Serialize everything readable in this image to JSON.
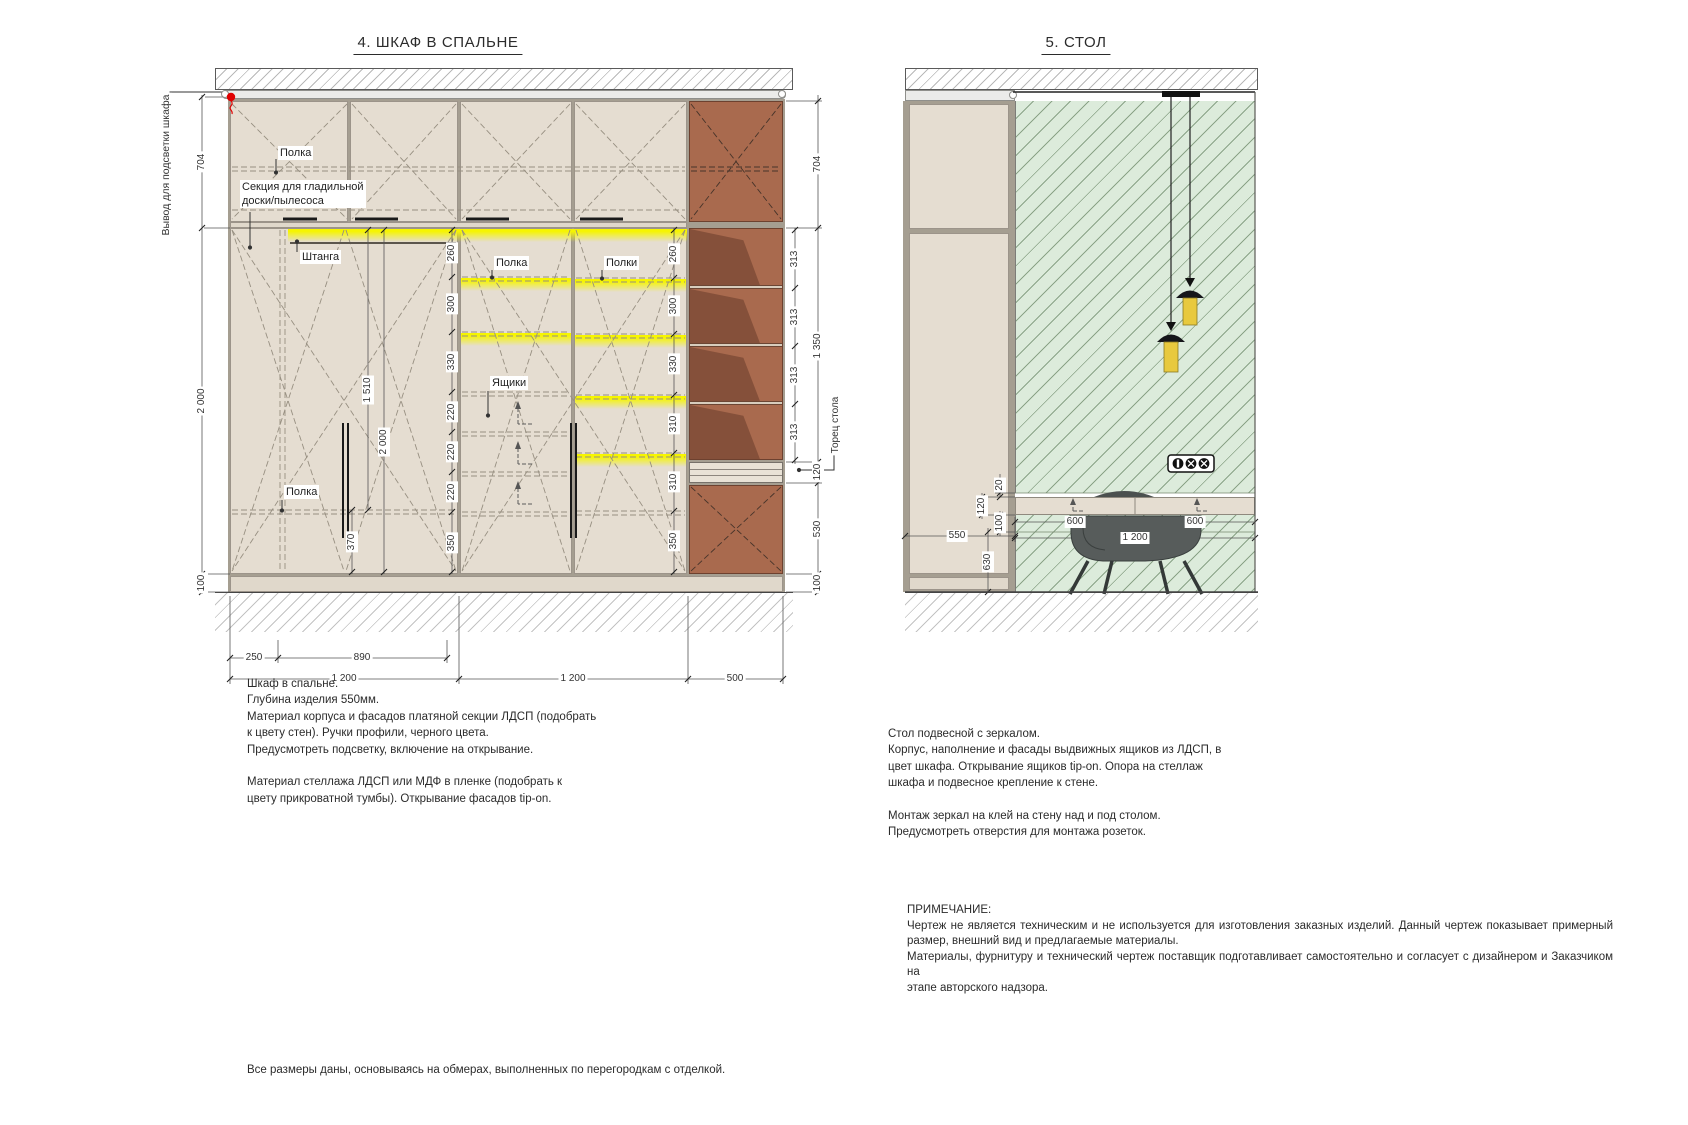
{
  "wardrobe": {
    "title": "4. ШКАФ В СПАЛЬНЕ",
    "callouts": {
      "lighting_output": "Вывод для подсветки шкафа",
      "shelf_top": "Полка",
      "ironing_line1": "Секция для гладильной",
      "ironing_line2": "доски/пылесоса",
      "rod": "Штанга",
      "shelf_left": "Полка",
      "shelf_mid": "Полка",
      "shelves_right": "Полки",
      "drawers": "Ящики",
      "desk_end": "Торец стола"
    },
    "dims": {
      "left": [
        "704",
        "2 000",
        "100"
      ],
      "right_outer": [
        "704",
        "1 350",
        "120",
        "530",
        "100"
      ],
      "open_shelf": [
        "313",
        "313",
        "313",
        "313"
      ],
      "chain_a": [
        "260",
        "300",
        "330",
        "220",
        "220",
        "220",
        "350"
      ],
      "chain_b": [
        "260",
        "300",
        "330",
        "310",
        "310",
        "350"
      ],
      "inner": [
        "1 510",
        "2 000",
        "370"
      ],
      "bottom_top_row": [
        "250",
        "890"
      ],
      "bottom_row": [
        "1 200",
        "1 200",
        "500"
      ]
    },
    "note": [
      "Шкаф в спальне.",
      "Глубина изделия 550мм.",
      "Материал корпуса и фасадов платяной секции ЛДСП (подобрать",
      "к цвету стен). Ручки профили, черного цвета.",
      "Предусмотреть подсветку, включение на открывание.",
      "",
      "Материал стеллажа ЛДСП или МДФ в пленке (подобрать к",
      "цвету прикроватной тумбы). Открывание фасадов tip-on."
    ]
  },
  "desk": {
    "title": "5. СТОЛ",
    "dims": {
      "gap": "20",
      "top": "120",
      "under": "100",
      "depth": "550",
      "below": "630",
      "left_half": "600",
      "right_half": "600",
      "width": "1 200"
    },
    "note": [
      "Стол подвесной с зеркалом.",
      "Корпус, наполнение и фасады выдвижных ящиков из ЛДСП, в",
      "цвет шкафа. Открывание ящиков tip-on. Опора на стеллаж",
      "шкафа и подвесное крепление к стене.",
      "",
      "Монтаж зеркал на клей на стену над и под столом.",
      "Предусмотреть отверстия для монтажа розеток."
    ]
  },
  "remark": {
    "title": "ПРИМЕЧАНИЕ:",
    "lines": [
      "Чертеж не является техническим и не используется для изготовления заказных изделий. Данный чертеж показывает примерный",
      "размер, внешний вид и предлагаемые материалы.",
      "Материалы, фурнитуру и технический чертеж поставщик подготавливает самостоятельно и согласует с дизайнером и Заказчиком на",
      "этапе авторского  надзора."
    ]
  },
  "footer": "Все размеры даны, основываясь на обмерах, выполненных по перегородкам с отделкой.",
  "colors": {
    "accent_red": "#e00000",
    "highlight_yellow": "#f6f500",
    "panel_beige": "#e5ddd1",
    "shelf_brown": "#a96a4e",
    "mirror_green": "#dcebdb"
  }
}
